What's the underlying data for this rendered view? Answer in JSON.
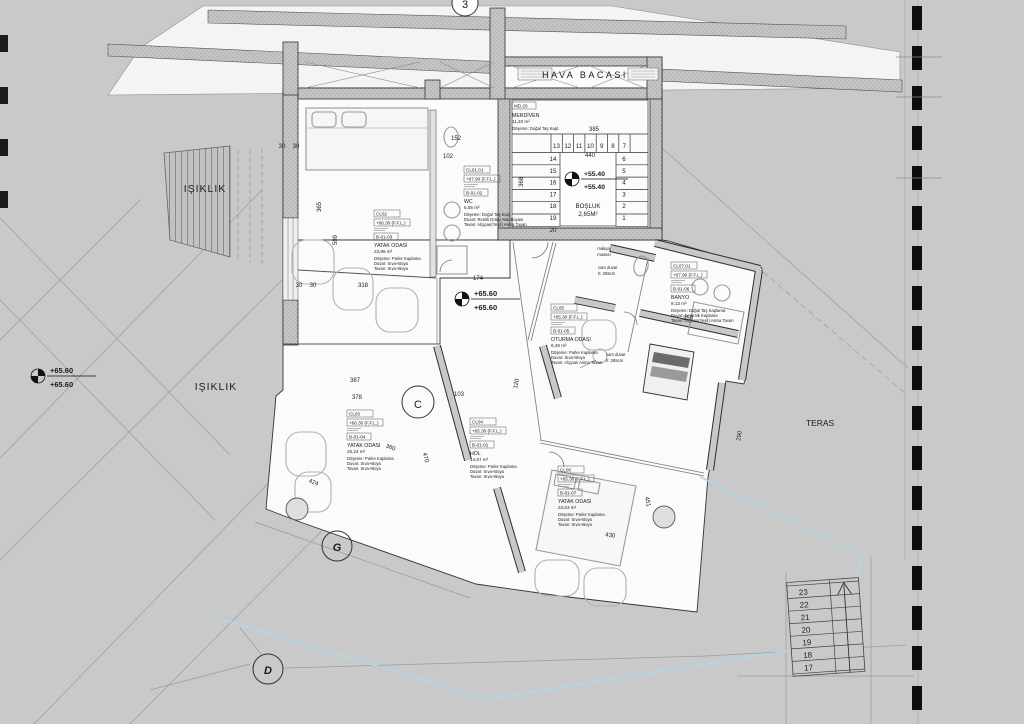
{
  "drawing": {
    "hava_bacasi": "HAVA BACASI",
    "isiklik_upper": "IŞIKLIK",
    "isiklik_lower": "IŞIKLIK",
    "teras": "TERAS",
    "bosluk": "BOŞLUK",
    "bosluk_area": "2,65M²",
    "cam_duvar_1a": "cam duvar",
    "cam_duvar_1b": "h: 265cm",
    "cam_duvar_2a": "cam duvar",
    "cam_duvar_2b": "h: 265cm",
    "makyaj_a": "makyaj",
    "makyaj_b": "masası"
  },
  "levels": {
    "stair_top": "+55.40",
    "stair_bottom": "+55.40",
    "center_top": "+65.60",
    "center_bottom": "+65.60",
    "left_top": "+65.60",
    "left_bottom": "+65.60"
  },
  "grid": {
    "g3": "3",
    "gc": "C",
    "gg": "G",
    "gd": "D"
  },
  "stair_core": {
    "code": "MD.20",
    "name": "MERDİVEN",
    "area": "11,32 m²",
    "floor": "Döşeme: Doğal Taş Kapl.",
    "wall": "Duvar: Sıva+Boya",
    "ceiling": "Tavan: Sıva+Boya",
    "top_row": [
      "13",
      "12",
      "11",
      "10",
      "9",
      "8",
      "7"
    ],
    "left_col": [
      "14",
      "15",
      "16",
      "17",
      "18",
      "19",
      "20"
    ],
    "right_col": [
      "6",
      "5",
      "4",
      "3",
      "2",
      "1"
    ]
  },
  "rooms": [
    {
      "id": "wc",
      "x": 464,
      "y": 166,
      "code": "CL01.01",
      "level": "+67.90 (F.F.L.)",
      "tag": "B-01-02",
      "name": "WC",
      "area": "5,55 m²",
      "floor": "Döşeme: Doğal Taş Kapl.",
      "wall": "Duvar: Renkli Dolgu Mat Boyası",
      "ceiling": "Tavan: Alçıpan(Yeşil) Asma Tavan"
    },
    {
      "id": "bedroom-1",
      "x": 374,
      "y": 210,
      "code": "CL02",
      "level": "+66.30 (F.F.L.)",
      "tag": "B-01-03",
      "name": "YATAK ODASI",
      "area": "23,95 m²",
      "floor": "Döşeme: Parke Kaplama",
      "wall": "Duvar: Sıva+Boya",
      "ceiling": "Tavan: Sıva+Boya"
    },
    {
      "id": "oturma-odasi",
      "x": 551,
      "y": 304,
      "code": "CL05",
      "level": "+65.30 (F.F.L.)",
      "tag": "B-01-05",
      "name": "OTURMA ODASI",
      "area": "8,49 m²",
      "floor": "Döşeme: Parke Kaplama",
      "wall": "Duvar: Sıva+Boya",
      "ceiling": "Tavan: Alçıpan Asma Tavan"
    },
    {
      "id": "banyo",
      "x": 671,
      "y": 262,
      "code": "CL07.01",
      "level": "+67.90 (F.F.L.)",
      "tag": "B-01-06",
      "name": "BANYO",
      "area": "9,13 m²",
      "floor": "Döşeme: Doğal Taş Kaplama",
      "wall": "Duvar: Seramik Kaplama",
      "ceiling": "Tavan: Alçıpan(Yeşil) Asma Tavan"
    },
    {
      "id": "hol",
      "x": 470,
      "y": 418,
      "code": "CL04",
      "level": "+65.30 (F.F.L.)",
      "tag": "B-01-01",
      "name": "HOL",
      "area": "14,67 m²",
      "floor": "Döşeme: Parke Kaplama",
      "wall": "Duvar: Sıva+Boya",
      "ceiling": "Tavan: Sıva+Boya"
    },
    {
      "id": "bedroom-2",
      "x": 347,
      "y": 410,
      "code": "CL03",
      "level": "+66.30 (F.F.L.)",
      "tag": "B-01-04",
      "name": "YATAK ODASI",
      "area": "26,24 m²",
      "floor": "Döşeme: Parke Kaplama",
      "wall": "Duvar: Sıva+Boya",
      "ceiling": "Tavan: Sıva+Boya"
    },
    {
      "id": "bedroom-3",
      "x": 558,
      "y": 466,
      "code": "CL06",
      "level": "+65.30 (F.F.L.)",
      "tag": "B-01-07",
      "name": "YATAK ODASI",
      "area": "23,63 m²",
      "floor": "Döşeme: Parke Kaplama",
      "wall": "Duvar: Sıva+Boya",
      "ceiling": "Tavan: Sıva+Boya"
    }
  ],
  "outdoor_stair": {
    "numbers": [
      "23",
      "22",
      "21",
      "20",
      "19",
      "18",
      "17"
    ]
  },
  "dimensions": [
    {
      "t": "318",
      "x": 363,
      "y": 287
    },
    {
      "t": "30",
      "x": 299,
      "y": 287
    },
    {
      "t": "30",
      "x": 313,
      "y": 287
    },
    {
      "t": "599",
      "x": 337,
      "y": 240,
      "r": -90
    },
    {
      "t": "365",
      "x": 321,
      "y": 207,
      "r": -90
    },
    {
      "t": "152",
      "x": 456,
      "y": 140
    },
    {
      "t": "102",
      "x": 448,
      "y": 158
    },
    {
      "t": "385",
      "x": 594,
      "y": 131
    },
    {
      "t": "440",
      "x": 590,
      "y": 157
    },
    {
      "t": "368",
      "x": 523,
      "y": 182,
      "r": -90
    },
    {
      "t": "174",
      "x": 478,
      "y": 280
    },
    {
      "t": "387",
      "x": 355,
      "y": 382
    },
    {
      "t": "378",
      "x": 357,
      "y": 399
    },
    {
      "t": "103",
      "x": 459,
      "y": 396
    },
    {
      "t": "120",
      "x": 518,
      "y": 384,
      "r": -78
    },
    {
      "t": "424",
      "x": 313,
      "y": 484,
      "r": 22
    },
    {
      "t": "470",
      "x": 424,
      "y": 458,
      "r": 75
    },
    {
      "t": "360",
      "x": 390,
      "y": 449,
      "r": 20
    },
    {
      "t": "290",
      "x": 741,
      "y": 436,
      "r": -82
    },
    {
      "t": "350",
      "x": 688,
      "y": 320
    },
    {
      "t": "430",
      "x": 610,
      "y": 537,
      "r": 10
    },
    {
      "t": "451",
      "x": 646,
      "y": 502,
      "r": 78
    },
    {
      "t": "30",
      "x": 282,
      "y": 148
    },
    {
      "t": "30",
      "x": 296,
      "y": 148
    }
  ]
}
